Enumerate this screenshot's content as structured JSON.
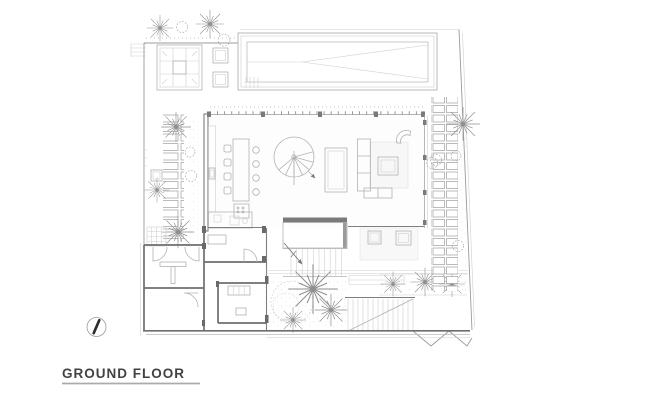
{
  "drawing": {
    "title": "GROUND FLOOR",
    "background_color": "#ffffff",
    "line_color": "#9b9b9b",
    "wall_color": "#6e6e6e",
    "furniture_line_color": "#b2b2b2",
    "title_color": "#424242",
    "underline_color": "#ababab",
    "icons": [
      "north-arrow-icon",
      "palm-tree-icon",
      "bush-icon",
      "spiral-staircase-icon",
      "stair-direction-arrow-icon"
    ],
    "features": [
      "swimming-pool",
      "pool-deck-daybed",
      "deck-ottomans",
      "stepping-stone-path-left",
      "stepping-stone-path-right",
      "kitchen-counter",
      "kitchen-island-dining-table",
      "spiral-staircase",
      "sunken-lounge-table",
      "l-shaped-sofa",
      "coffee-table",
      "lounge-chair",
      "media-seats",
      "entry-hall-double-doors",
      "bathroom-and-storage-rooms",
      "main-staircase",
      "courtyard-garden",
      "terrace-stairs",
      "site-boundary"
    ]
  }
}
